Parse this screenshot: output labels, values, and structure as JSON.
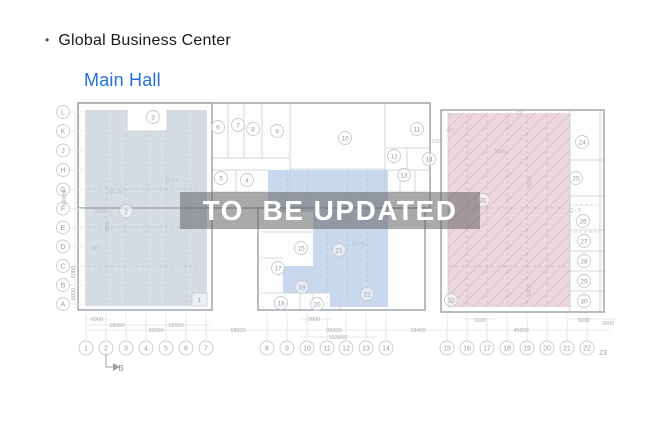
{
  "header": {
    "bullet": "•",
    "title": "Global Business Center",
    "subtitle": "Main Hall"
  },
  "watermark": {
    "text": "TO  BE UPDATED"
  },
  "plan": {
    "colors": {
      "wall": "#c9ccd2",
      "outline": "#a7abb2",
      "circle_stroke": "#c8cbd0",
      "circle_text": "#969ba3",
      "dim_text": "#a6abb2",
      "note_text": "#b4b9c0",
      "grid_conn": "#dfe1e5",
      "dash_blue": "rgba(120,132,152,0.30)",
      "dash_pink": "rgba(175,120,140,0.38)",
      "hatch": "rgba(190,132,152,0.30)",
      "building_fill": "#fdfdfe"
    },
    "buildings": [
      {
        "x": 78,
        "y": 103,
        "w": 352,
        "h": 105
      },
      {
        "x": 78,
        "y": 103,
        "w": 134,
        "h": 207
      },
      {
        "x": 258,
        "y": 208,
        "w": 167,
        "h": 102
      },
      {
        "x": 441,
        "y": 110,
        "w": 163,
        "h": 202
      }
    ],
    "regions": [
      {
        "name": "left-gray",
        "fill": "#ccd4dd",
        "opacity": 0.82,
        "points": "85,110 127,110 127,131 167,131 167,110 207,110 207,306 85,306"
      },
      {
        "name": "middle-blue",
        "fill": "#c2d3eb",
        "opacity": 0.88,
        "points": "268,170 388,170 388,307 330,307 330,293 283,293 283,266 313,266 313,212 268,212"
      },
      {
        "name": "right-pink",
        "fill": "#e9cfd9",
        "opacity": 0.85,
        "hatch": true,
        "points": "448,113 570,113 570,307 448,307"
      }
    ],
    "region_grid": [
      {
        "x1": 106,
        "y1": 114,
        "x2": 106,
        "y2": 304,
        "c": "blue"
      },
      {
        "x1": 126,
        "y1": 134,
        "x2": 126,
        "y2": 304,
        "c": "blue"
      },
      {
        "x1": 146,
        "y1": 134,
        "x2": 146,
        "y2": 304,
        "c": "blue"
      },
      {
        "x1": 166,
        "y1": 134,
        "x2": 166,
        "y2": 304,
        "c": "blue"
      },
      {
        "x1": 186,
        "y1": 114,
        "x2": 186,
        "y2": 304,
        "c": "blue"
      },
      {
        "x1": 87,
        "y1": 189,
        "x2": 206,
        "y2": 189,
        "c": "blue"
      },
      {
        "x1": 87,
        "y1": 227,
        "x2": 206,
        "y2": 227,
        "c": "blue"
      },
      {
        "x1": 87,
        "y1": 266,
        "x2": 206,
        "y2": 266,
        "c": "blue"
      },
      {
        "x1": 347,
        "y1": 172,
        "x2": 347,
        "y2": 304,
        "c": "blue"
      },
      {
        "x1": 367,
        "y1": 172,
        "x2": 367,
        "y2": 304,
        "c": "blue"
      },
      {
        "x1": 327,
        "y1": 230,
        "x2": 327,
        "y2": 304,
        "c": "blue"
      },
      {
        "x1": 287,
        "y1": 172,
        "x2": 287,
        "y2": 210,
        "c": "blue"
      },
      {
        "x1": 307,
        "y1": 172,
        "x2": 307,
        "y2": 210,
        "c": "blue"
      },
      {
        "x1": 467,
        "y1": 115,
        "x2": 467,
        "y2": 305,
        "c": "pink"
      },
      {
        "x1": 487,
        "y1": 115,
        "x2": 487,
        "y2": 305,
        "c": "pink"
      },
      {
        "x1": 507,
        "y1": 115,
        "x2": 507,
        "y2": 305,
        "c": "pink"
      },
      {
        "x1": 527,
        "y1": 115,
        "x2": 527,
        "y2": 305,
        "c": "pink"
      },
      {
        "x1": 547,
        "y1": 115,
        "x2": 547,
        "y2": 305,
        "c": "pink"
      },
      {
        "x1": 449,
        "y1": 208,
        "x2": 569,
        "y2": 208,
        "c": "pink"
      },
      {
        "x1": 449,
        "y1": 266,
        "x2": 569,
        "y2": 266,
        "c": "pink"
      }
    ],
    "walls": [
      [
        228,
        103,
        228,
        158
      ],
      [
        244,
        103,
        244,
        158
      ],
      [
        262,
        103,
        262,
        158
      ],
      [
        290,
        103,
        290,
        208
      ],
      [
        212,
        158,
        290,
        158
      ],
      [
        385,
        103,
        385,
        208
      ],
      [
        290,
        169,
        385,
        169
      ],
      [
        212,
        170,
        268,
        170
      ],
      [
        212,
        192,
        268,
        192
      ],
      [
        236,
        170,
        236,
        192
      ],
      [
        385,
        148,
        430,
        148
      ],
      [
        385,
        170,
        430,
        170
      ],
      [
        385,
        192,
        430,
        192
      ],
      [
        407,
        148,
        407,
        170
      ],
      [
        400,
        170,
        400,
        192
      ],
      [
        415,
        170,
        415,
        192
      ],
      [
        127,
        110,
        127,
        131
      ],
      [
        167,
        110,
        167,
        131
      ],
      [
        127,
        131,
        167,
        131
      ],
      [
        262,
        232,
        313,
        232
      ],
      [
        262,
        258,
        283,
        258
      ],
      [
        262,
        293,
        330,
        293
      ],
      [
        300,
        293,
        300,
        310
      ],
      [
        313,
        293,
        313,
        310
      ],
      [
        340,
        293,
        340,
        310
      ],
      [
        570,
        110,
        570,
        312
      ],
      [
        600,
        110,
        600,
        312
      ],
      [
        570,
        160,
        604,
        160
      ],
      [
        570,
        196,
        604,
        196
      ],
      [
        570,
        230,
        604,
        230
      ],
      [
        570,
        251,
        604,
        251
      ],
      [
        570,
        271,
        604,
        271
      ],
      [
        570,
        291,
        604,
        291
      ],
      [
        448,
        113,
        448,
        307
      ]
    ],
    "rooms": [
      {
        "n": "3",
        "x": 153,
        "y": 117
      },
      {
        "n": "6",
        "x": 218,
        "y": 127
      },
      {
        "n": "7",
        "x": 238,
        "y": 125
      },
      {
        "n": "8",
        "x": 253,
        "y": 129
      },
      {
        "n": "9",
        "x": 277,
        "y": 131
      },
      {
        "n": "10",
        "x": 345,
        "y": 138
      },
      {
        "n": "11",
        "x": 417,
        "y": 129
      },
      {
        "n": "12",
        "x": 394,
        "y": 156
      },
      {
        "n": "13",
        "x": 404,
        "y": 175
      },
      {
        "n": "14",
        "x": 429,
        "y": 159
      },
      {
        "n": "5",
        "x": 221,
        "y": 178
      },
      {
        "n": "4",
        "x": 247,
        "y": 180
      },
      {
        "n": "2",
        "x": 126,
        "y": 211
      },
      {
        "n": "15",
        "x": 301,
        "y": 248
      },
      {
        "n": "17",
        "x": 278,
        "y": 268
      },
      {
        "n": "19",
        "x": 302,
        "y": 287
      },
      {
        "n": "18",
        "x": 281,
        "y": 303
      },
      {
        "n": "20",
        "x": 317,
        "y": 304
      },
      {
        "n": "21",
        "x": 339,
        "y": 250
      },
      {
        "n": "22",
        "x": 367,
        "y": 294
      },
      {
        "n": "24",
        "x": 582,
        "y": 142
      },
      {
        "n": "25",
        "x": 576,
        "y": 178
      },
      {
        "n": "26",
        "x": 583,
        "y": 221
      },
      {
        "n": "27",
        "x": 584,
        "y": 241
      },
      {
        "n": "28",
        "x": 584,
        "y": 261
      },
      {
        "n": "29",
        "x": 584,
        "y": 281
      },
      {
        "n": "30",
        "x": 584,
        "y": 301
      },
      {
        "n": "31",
        "x": 483,
        "y": 200
      },
      {
        "n": "32",
        "x": 451,
        "y": 300
      }
    ],
    "boxes_small": [
      {
        "x": 192,
        "y": 293,
        "w": 15,
        "h": 13,
        "t": "1"
      }
    ],
    "dashed_boxes": [
      {
        "x": 570,
        "y": 205,
        "w": 30,
        "h": 27
      }
    ],
    "row_axes": [
      {
        "label": "L",
        "y": 112
      },
      {
        "label": "K",
        "y": 131
      },
      {
        "label": "J",
        "y": 150.5
      },
      {
        "label": "H",
        "y": 170
      },
      {
        "label": "G",
        "y": 189.5
      },
      {
        "label": "F",
        "y": 208.5
      },
      {
        "label": "E",
        "y": 227.5
      },
      {
        "label": "D",
        "y": 246.5
      },
      {
        "label": "C",
        "y": 266
      },
      {
        "label": "B",
        "y": 285
      },
      {
        "label": "A",
        "y": 304
      }
    ],
    "col_axes": [
      {
        "label": "1",
        "x": 86
      },
      {
        "label": "2",
        "x": 106
      },
      {
        "label": "3",
        "x": 126
      },
      {
        "label": "4",
        "x": 146
      },
      {
        "label": "5",
        "x": 166
      },
      {
        "label": "6",
        "x": 186
      },
      {
        "label": "7",
        "x": 206
      },
      {
        "label": "8",
        "x": 267
      },
      {
        "label": "9",
        "x": 287
      },
      {
        "label": "10",
        "x": 307
      },
      {
        "label": "11",
        "x": 327
      },
      {
        "label": "12",
        "x": 346
      },
      {
        "label": "13",
        "x": 366
      },
      {
        "label": "14",
        "x": 386
      },
      {
        "label": "15",
        "x": 447
      },
      {
        "label": "16",
        "x": 467
      },
      {
        "label": "17",
        "x": 487
      },
      {
        "label": "18",
        "x": 507
      },
      {
        "label": "19",
        "x": 527
      },
      {
        "label": "20",
        "x": 547
      },
      {
        "label": "21",
        "x": 567
      },
      {
        "label": "22",
        "x": 587
      }
    ],
    "axis_23": {
      "label": "23",
      "x": 603,
      "y": 355
    },
    "axis_y": 348,
    "dim_lines": [
      [
        85,
        319,
        110,
        319
      ],
      [
        298,
        319,
        332,
        319
      ],
      [
        463,
        319,
        497,
        319
      ],
      [
        568,
        319,
        616,
        319
      ],
      [
        85,
        325,
        210,
        325
      ],
      [
        85,
        330,
        610,
        330
      ],
      [
        300,
        337,
        377,
        337
      ],
      [
        75,
        112,
        75,
        306
      ]
    ],
    "dims": [
      {
        "t": "6000",
        "x": 97,
        "y": 321
      },
      {
        "t": "18000",
        "x": 117,
        "y": 327
      },
      {
        "t": "18000",
        "x": 176,
        "y": 327
      },
      {
        "t": "36000",
        "x": 156,
        "y": 332
      },
      {
        "t": "18000",
        "x": 238,
        "y": 332
      },
      {
        "t": "2000",
        "x": 314,
        "y": 321
      },
      {
        "t": "36000",
        "x": 334,
        "y": 332
      },
      {
        "t": "153660",
        "x": 338,
        "y": 339
      },
      {
        "t": "19400",
        "x": 418,
        "y": 332
      },
      {
        "t": "1000",
        "x": 480,
        "y": 322
      },
      {
        "t": "45000",
        "x": 521,
        "y": 332
      },
      {
        "t": "6000",
        "x": 584,
        "y": 322
      },
      {
        "t": "3000",
        "x": 608,
        "y": 325
      },
      {
        "t": "60000",
        "x": 66,
        "y": 198,
        "rot": -90
      },
      {
        "t": "6000",
        "x": 75,
        "y": 272,
        "rot": -90
      },
      {
        "t": "6000",
        "x": 75,
        "y": 294,
        "rot": -90
      }
    ],
    "notes": [
      {
        "t": "Q + 3",
        "x": 172,
        "y": 182
      },
      {
        "t": "Q + 3",
        "x": 115,
        "y": 194
      },
      {
        "t": "2000",
        "x": 100,
        "y": 213
      },
      {
        "t": "Q + 3",
        "x": 358,
        "y": 245
      },
      {
        "t": "Q - 3",
        "x": 575,
        "y": 212
      },
      {
        "t": "1000",
        "x": 437,
        "y": 143
      },
      {
        "t": "1800",
        "x": 500,
        "y": 153
      },
      {
        "t": "23",
        "x": 519,
        "y": 115
      },
      {
        "t": "45°",
        "x": 450,
        "y": 132
      },
      {
        "t": "45°",
        "x": 95,
        "y": 250
      },
      {
        "t": "6000",
        "x": 531,
        "y": 182,
        "rot": -90
      },
      {
        "t": "6000",
        "x": 531,
        "y": 290,
        "rot": -90
      },
      {
        "t": "5000",
        "x": 109,
        "y": 226,
        "rot": -90
      }
    ],
    "marker": {
      "label": "B",
      "lines": [
        [
          106,
          354,
          106,
          367
        ],
        [
          106,
          367,
          115,
          367
        ]
      ],
      "arrow": "113,363 120,367 113,371",
      "tx": 121,
      "ty": 371
    }
  }
}
